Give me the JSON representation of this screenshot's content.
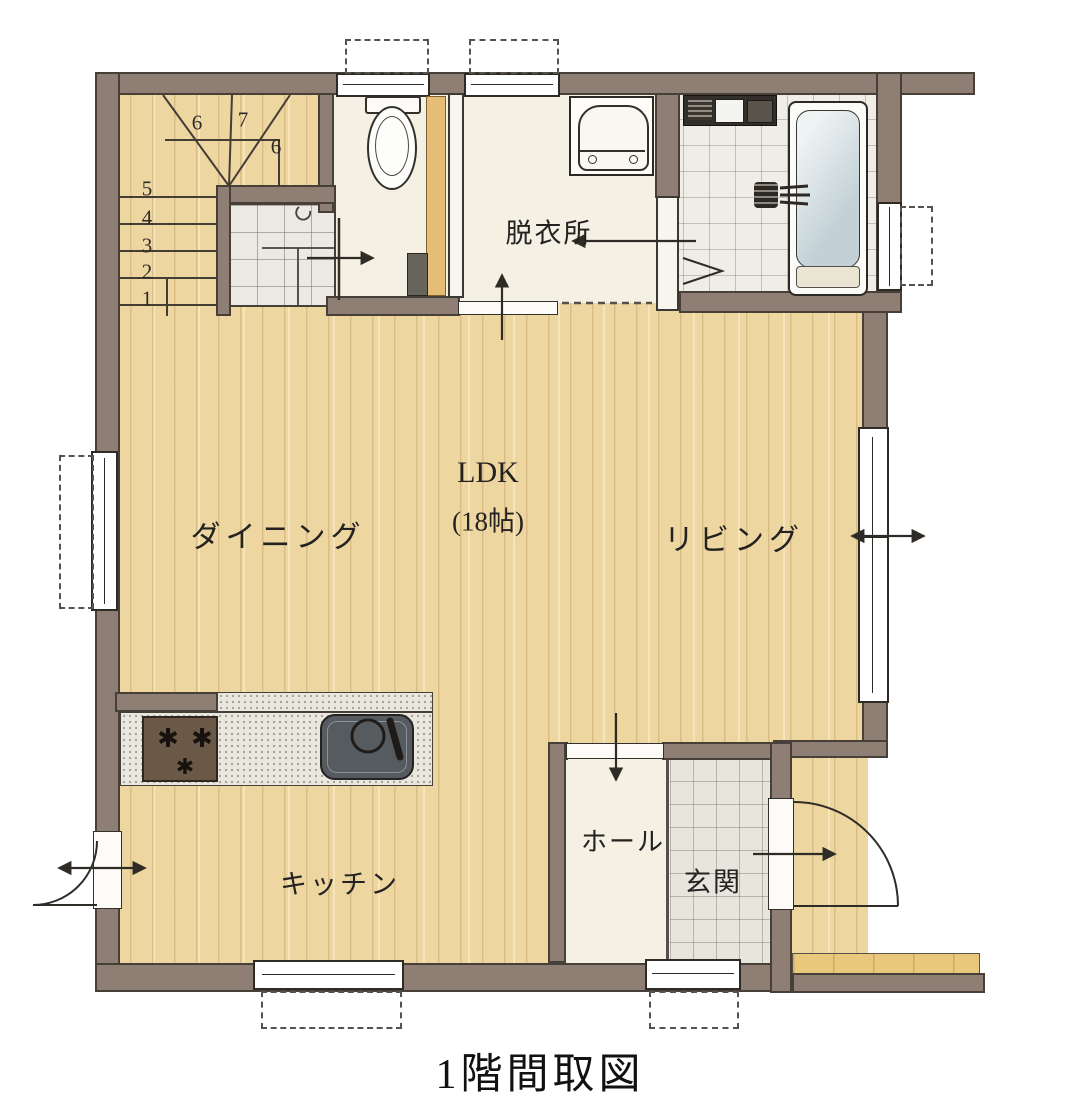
{
  "title": "1階間取図",
  "rooms": {
    "ldk": {
      "label": "LDK",
      "area": "(18帖)"
    },
    "dining": {
      "label": "ダイニング"
    },
    "living": {
      "label": "リビング"
    },
    "kitchen": {
      "label": "キッチン"
    },
    "dressing_room": {
      "label": "脱衣所"
    },
    "hall": {
      "label": "ホール"
    },
    "entrance": {
      "label": "玄関"
    }
  },
  "stairs": {
    "lower_steps": [
      "1",
      "2",
      "3",
      "4",
      "5"
    ],
    "upper_steps": [
      "6",
      "7",
      "6"
    ]
  },
  "colors": {
    "wall": "#8e7e73",
    "wood_floor": "#eed6a1",
    "tile_light": "#efede6",
    "cream_floor": "#f4f0e4",
    "porch_wood": "#e9c87e"
  }
}
